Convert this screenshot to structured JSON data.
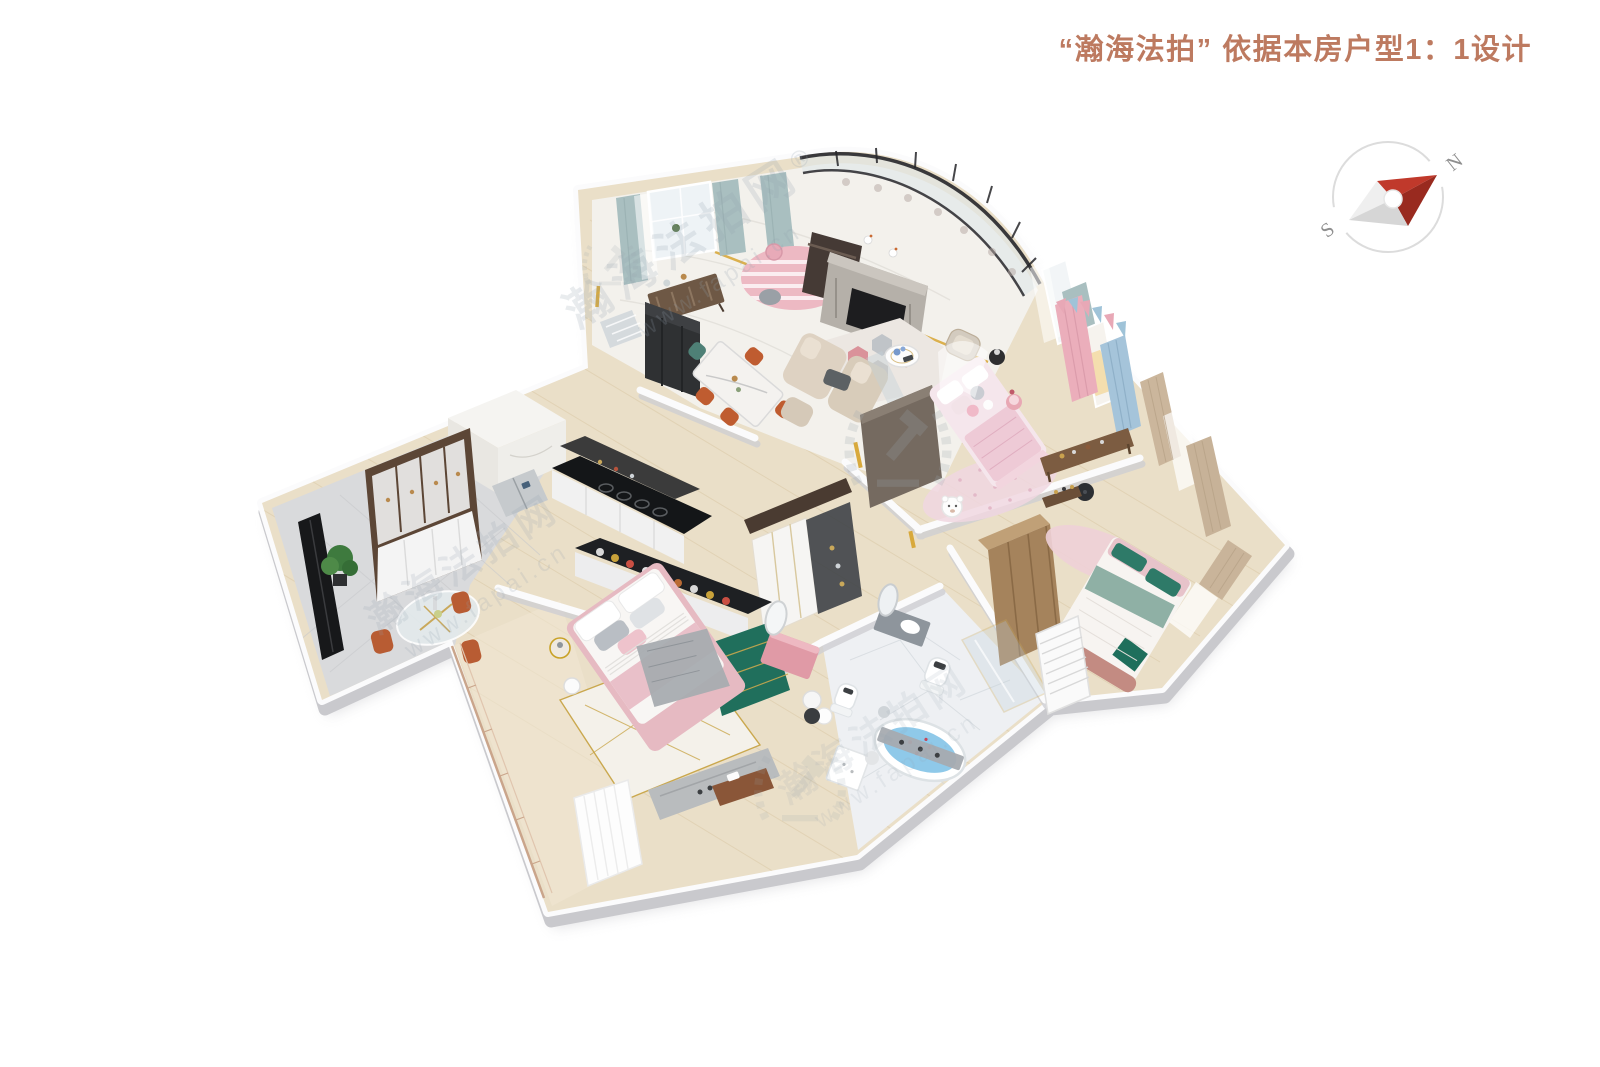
{
  "header": {
    "title": "“瀚海法拍” 依据本房户型1：1设计"
  },
  "compass": {
    "north_label": "N",
    "south_label": "S"
  },
  "watermark": {
    "site_name": "瀚海法拍网",
    "registered_mark": "®",
    "site_url": "www.fapai.cn"
  },
  "colors": {
    "title_text": "#bd7a60",
    "compass_needle_red": "#c0392b",
    "compass_needle_red_dark": "#992a1f",
    "accent_gold": "#d8a93c",
    "watermark_gray": "#93a2af"
  }
}
